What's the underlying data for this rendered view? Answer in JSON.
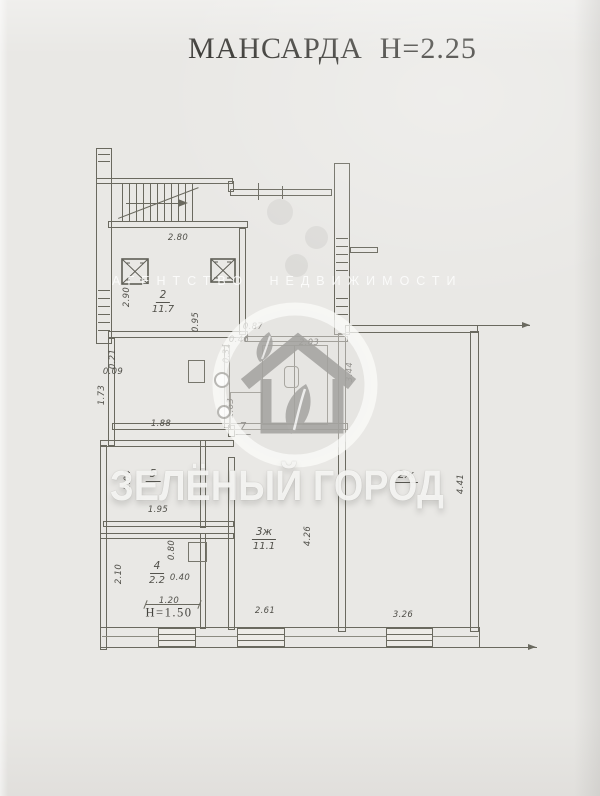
{
  "title": "МАНСАРДА  Н=2.25",
  "watermark": {
    "agency": "АГЕНТСТВО НЕДВИЖИМОСТИ",
    "brand": "ЗЕЛЁНЫЙ ГОРОД",
    "logo_icon": "house-with-leaves-in-circle"
  },
  "colors": {
    "paper": "#e9e8e5",
    "plan_line": "#6a695f",
    "label_text": "#504f49",
    "title_text": "#373632",
    "watermark_white": "#fdfdfb",
    "logo_gray": "#a7a6a3"
  },
  "plan": {
    "floor_title": "МАНСАРДА",
    "ceiling_height": "Н=2.25",
    "knee_wall_note": "Н=1.50",
    "rooms": [
      {
        "num": "2",
        "area": "11.7",
        "x": 163,
        "y": 283
      },
      {
        "num": "7",
        "area": "",
        "x": 243,
        "y": 415
      },
      {
        "num": "5",
        "area": "",
        "x": 153,
        "y": 462
      },
      {
        "num": "4",
        "area": "2.2",
        "x": 157,
        "y": 554
      },
      {
        "num": "3ж",
        "area": "11.1",
        "x": 264,
        "y": 520
      },
      {
        "num": "2ж",
        "area": "",
        "x": 406,
        "y": 463
      }
    ],
    "dims": [
      {
        "t": "2.80",
        "x": 178,
        "y": 238
      },
      {
        "t": "2.90",
        "x": 127,
        "y": 297,
        "v": 1
      },
      {
        "t": "0.95",
        "x": 196,
        "y": 322,
        "v": 1
      },
      {
        "t": "0.87",
        "x": 253,
        "y": 327
      },
      {
        "t": "0.46",
        "x": 239,
        "y": 340
      },
      {
        "t": "0.31",
        "x": 227,
        "y": 353,
        "v": 1
      },
      {
        "t": "0.21",
        "x": 113,
        "y": 359,
        "v": 1
      },
      {
        "t": "0.09",
        "x": 113,
        "y": 372
      },
      {
        "t": "1.73",
        "x": 102,
        "y": 395,
        "v": 1
      },
      {
        "t": "1.88",
        "x": 161,
        "y": 424
      },
      {
        "t": "1.63",
        "x": 231,
        "y": 408,
        "v": 1
      },
      {
        "t": "2.03",
        "x": 309,
        "y": 343
      },
      {
        "t": "3.44",
        "x": 350,
        "y": 372,
        "v": 1
      },
      {
        "t": "2.04",
        "x": 128,
        "y": 480,
        "v": 1
      },
      {
        "t": "1.95",
        "x": 158,
        "y": 510
      },
      {
        "t": "2.10",
        "x": 119,
        "y": 574,
        "v": 1
      },
      {
        "t": "0.80",
        "x": 172,
        "y": 550,
        "v": 1
      },
      {
        "t": "0.40",
        "x": 180,
        "y": 578
      },
      {
        "t": "1.20",
        "x": 169,
        "y": 601
      },
      {
        "t": "Н=1.50",
        "x": 169,
        "y": 613,
        "n": 1
      },
      {
        "t": "2.61",
        "x": 265,
        "y": 611
      },
      {
        "t": "4.26",
        "x": 308,
        "y": 536,
        "v": 1
      },
      {
        "t": "4.41",
        "x": 461,
        "y": 484,
        "v": 1
      },
      {
        "t": "3.26",
        "x": 403,
        "y": 615
      }
    ]
  }
}
